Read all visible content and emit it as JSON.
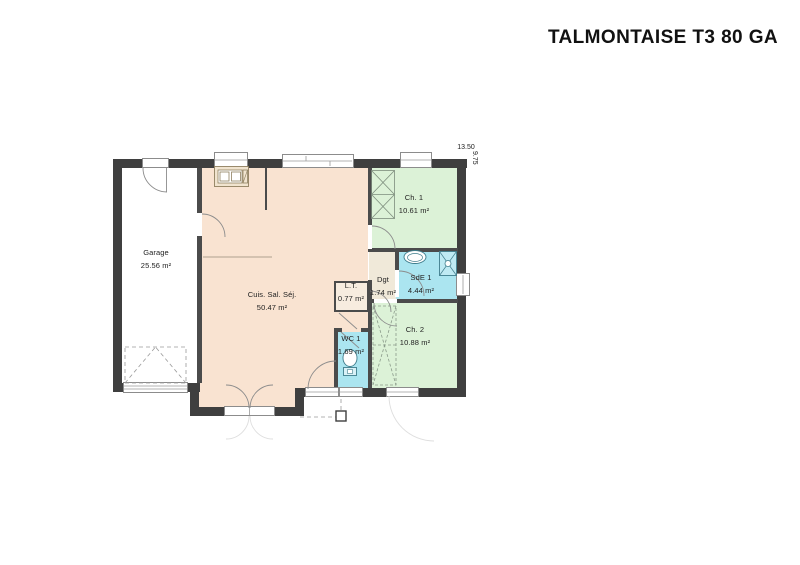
{
  "header": {
    "title": "TALMONTAISE T3 80 GA"
  },
  "plan": {
    "dimensions": {
      "width": "13.50",
      "height": "9.75"
    },
    "rooms": [
      {
        "name": "Garage",
        "area": "25.56 m²"
      },
      {
        "name": "Cuis. Sal. Séj.",
        "area": "50.47 m²"
      },
      {
        "name": "Ch. 1",
        "area": "10.61 m²"
      },
      {
        "name": "SdE 1",
        "area": "4.44 m²"
      },
      {
        "name": "Dgt",
        "area": "1.74 m²"
      },
      {
        "name": "L.T.",
        "area": "0.77 m²"
      },
      {
        "name": "WC 1",
        "area": "1.69 m²"
      },
      {
        "name": "Ch. 2",
        "area": "10.88 m²"
      }
    ],
    "colors": {
      "wall": "#3f3f3f",
      "iwall": "#4b4b4b",
      "living": "#f9e3d1",
      "bedroom": "#dcf2d7",
      "wet": "#abe5f0",
      "hall": "#f0e9d9",
      "closet": "#f7ecdf"
    }
  }
}
